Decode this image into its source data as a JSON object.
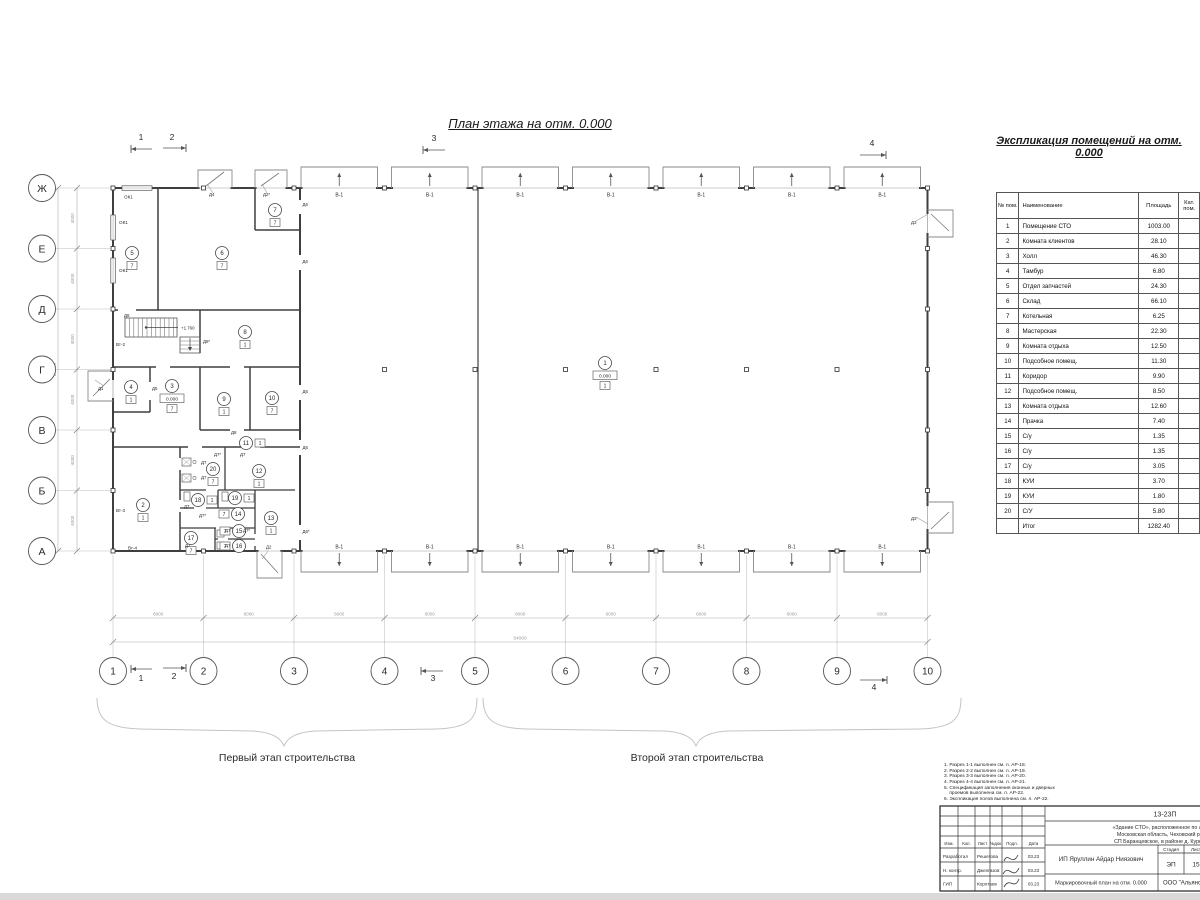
{
  "plan_title": "План этажа на отм. 0.000",
  "schedule": {
    "title": "Экспликация помещений на отм. 0.000",
    "col_headers": [
      "№ пом.",
      "Наименование",
      "Площадь",
      "Кат. пом."
    ],
    "rows": [
      [
        "1",
        "Помещение СТО",
        "1003.00"
      ],
      [
        "2",
        "Комната клиентов",
        "28.10"
      ],
      [
        "3",
        "Холл",
        "46.30"
      ],
      [
        "4",
        "Тамбур",
        "6.80"
      ],
      [
        "5",
        "Отдел запчастей",
        "24.30"
      ],
      [
        "6",
        "Склад",
        "66.10"
      ],
      [
        "7",
        "Котельная",
        "6.25"
      ],
      [
        "8",
        "Мастерская",
        "22.30"
      ],
      [
        "9",
        "Комната отдыха",
        "12.50"
      ],
      [
        "10",
        "Подсобное помещ.",
        "11.30"
      ],
      [
        "11",
        "Коридор",
        "9.90"
      ],
      [
        "12",
        "Подсобное помещ.",
        "8.50"
      ],
      [
        "13",
        "Комната отдыха",
        "12.60"
      ],
      [
        "14",
        "Прачка",
        "7.40"
      ],
      [
        "15",
        "С/у",
        "1.35"
      ],
      [
        "16",
        "С/у",
        "1.35"
      ],
      [
        "17",
        "С/у",
        "3.05"
      ],
      [
        "18",
        "КУИ",
        "3.70"
      ],
      [
        "19",
        "КУИ",
        "1.80"
      ],
      [
        "20",
        "С/У",
        "5.80"
      ]
    ],
    "total_label": "Итог",
    "total_area": "1282.40"
  },
  "grid": {
    "cols": [
      "1",
      "2",
      "3",
      "4",
      "5",
      "6",
      "7",
      "8",
      "9",
      "10"
    ],
    "rows": [
      "Ж",
      "Е",
      "Д",
      "Г",
      "В",
      "Б",
      "А"
    ],
    "bay_dim": "6000",
    "total_width_dim": "54000",
    "row_dim": "4000",
    "total_height_dim": "24000"
  },
  "stages": {
    "first": "Первый этап строительства",
    "second": "Второй этап строительства"
  },
  "section_marks": [
    "1",
    "2",
    "3",
    "4"
  ],
  "plan_labels": {
    "gate": "В-1",
    "elev_zero": "0.000",
    "stair_elev": "+1.760",
    "room_tags": [
      {
        "n": "1",
        "box": "1",
        "x": 605,
        "y": 363,
        "bp": "b",
        "elev": "0.000"
      },
      {
        "n": "2",
        "box": "1",
        "x": 143,
        "y": 505,
        "bp": "b"
      },
      {
        "n": "3",
        "box": "7",
        "x": 172,
        "y": 386,
        "bp": "b",
        "elev": "0.000"
      },
      {
        "n": "4",
        "box": "1",
        "x": 131,
        "y": 387,
        "bp": "b"
      },
      {
        "n": "5",
        "box": "7",
        "x": 132,
        "y": 253,
        "bp": "b"
      },
      {
        "n": "6",
        "box": "7",
        "x": 222,
        "y": 253,
        "bp": "b"
      },
      {
        "n": "7",
        "box": "7",
        "x": 275,
        "y": 210,
        "bp": "b"
      },
      {
        "n": "8",
        "box": "1",
        "x": 245,
        "y": 332,
        "bp": "b"
      },
      {
        "n": "9",
        "box": "1",
        "x": 224,
        "y": 399,
        "bp": "b"
      },
      {
        "n": "10",
        "box": "7",
        "x": 272,
        "y": 398,
        "bp": "b"
      },
      {
        "n": "11",
        "box": "1",
        "x": 246,
        "y": 443,
        "bp": "r"
      },
      {
        "n": "12",
        "box": "1",
        "x": 259,
        "y": 471,
        "bp": "b"
      },
      {
        "n": "13",
        "box": "1",
        "x": 271,
        "y": 518,
        "bp": "b"
      },
      {
        "n": "14",
        "box": "7",
        "x": 238,
        "y": 514,
        "bp": "l"
      },
      {
        "n": "15",
        "box": "7",
        "x": 239,
        "y": 531,
        "bp": "l"
      },
      {
        "n": "16",
        "box": "7",
        "x": 239,
        "y": 546,
        "bp": "l"
      },
      {
        "n": "17",
        "box": "7",
        "x": 191,
        "y": 538,
        "bp": "b"
      },
      {
        "n": "18",
        "box": "1",
        "x": 198,
        "y": 500,
        "bp": "r"
      },
      {
        "n": "19",
        "box": "1",
        "x": 235,
        "y": 498,
        "bp": "r"
      },
      {
        "n": "20",
        "box": "7",
        "x": 213,
        "y": 469,
        "bp": "b"
      }
    ],
    "door_labels": [
      {
        "t": "Д4",
        "x": 209,
        "y": 196
      },
      {
        "t": "Д2*",
        "x": 263,
        "y": 196
      },
      {
        "t": "Д3",
        "x": 911,
        "y": 224
      },
      {
        "t": "Д3",
        "x": 911,
        "y": 520
      },
      {
        "t": "Д1",
        "x": 98,
        "y": 390
      },
      {
        "t": "Д5",
        "x": 152,
        "y": 390
      },
      {
        "t": "Д8",
        "x": 124,
        "y": 317
      },
      {
        "t": "Д8*",
        "x": 203,
        "y": 343
      },
      {
        "t": "Д8",
        "x": 231,
        "y": 434
      },
      {
        "t": "Д6",
        "x": 302.5,
        "y": 206
      },
      {
        "t": "Д6",
        "x": 302.5,
        "y": 263
      },
      {
        "t": "Д6",
        "x": 302.5,
        "y": 393
      },
      {
        "t": "Д6",
        "x": 302.5,
        "y": 449
      },
      {
        "t": "Д6*",
        "x": 302.5,
        "y": 533
      },
      {
        "t": "Д7*",
        "x": 214,
        "y": 456
      },
      {
        "t": "Д7",
        "x": 240,
        "y": 456
      },
      {
        "t": "Д7",
        "x": 201,
        "y": 464
      },
      {
        "t": "Д7",
        "x": 201,
        "y": 479
      },
      {
        "t": "Д7",
        "x": 184,
        "y": 508
      },
      {
        "t": "Д7*",
        "x": 199,
        "y": 517
      },
      {
        "t": "Д7",
        "x": 225,
        "y": 532
      },
      {
        "t": "Д7*",
        "x": 243,
        "y": 532
      },
      {
        "t": "Д7",
        "x": 185,
        "y": 547
      },
      {
        "t": "Д7",
        "x": 225,
        "y": 547
      },
      {
        "t": "Д2",
        "x": 266,
        "y": 548.5
      }
    ],
    "misc_labels": [
      {
        "t": "ОК1",
        "x": 124,
        "y": 198.5
      },
      {
        "t": "ОК1",
        "x": 119,
        "y": 224
      },
      {
        "t": "ОК1",
        "x": 119,
        "y": 272
      },
      {
        "t": "Вт-2",
        "x": 116,
        "y": 346
      },
      {
        "t": "Вт-3",
        "x": 116,
        "y": 512
      },
      {
        "t": "Вт-4",
        "x": 128,
        "y": 549.5
      }
    ]
  },
  "notes": [
    "1. Разрез 1-1 выполнен см. л. АР-18.",
    "2. Разрез 2-2 выполнен см. л. АР-19.",
    "3. Разрез 3-3 выполнен см. л. АР-20.",
    "4. Разрез 4-4 выполнен см. л. АР-21.",
    "5. Спецификация заполнения оконных и дверных",
    "    проемов выполнена см. л. АР-22.",
    "6. Экспликация полов выполнена см. л. АР-22."
  ],
  "titleblock": {
    "code": "13-23П",
    "address_lines": [
      "«Здание СТО», расположенное по адресу:",
      "Московская область, Чеховский район,",
      "СП Баранцевское, в районе д. Курниково"
    ],
    "header_cols": [
      "Изм.",
      "Кол.",
      "Лист",
      "№док.",
      "Подл.",
      "Дата"
    ],
    "sign_rows": [
      {
        "role": "Разработал",
        "name": "Решетова",
        "date": "03.23"
      },
      {
        "role": "Н. контр.",
        "name": "Джелгазов",
        "date": "03.23"
      },
      {
        "role": "ГИП",
        "name": "Коротаев",
        "date": "03.23"
      }
    ],
    "client": "ИП Яруллин Айдар Ниязович",
    "stage_label": "Стадия",
    "sheet_label": "Лист",
    "stage": "ЭП",
    "sheet": "15",
    "doc_title": "Маркировочный план на отм. 0.000",
    "company": "ООО \"Альянс\""
  },
  "colors": {
    "wall": "#3f3f3f",
    "thin": "#8a8a8a",
    "grid": "#bdbdbd",
    "dim_text": "#9a9a9a",
    "text": "#2a2a2a"
  }
}
